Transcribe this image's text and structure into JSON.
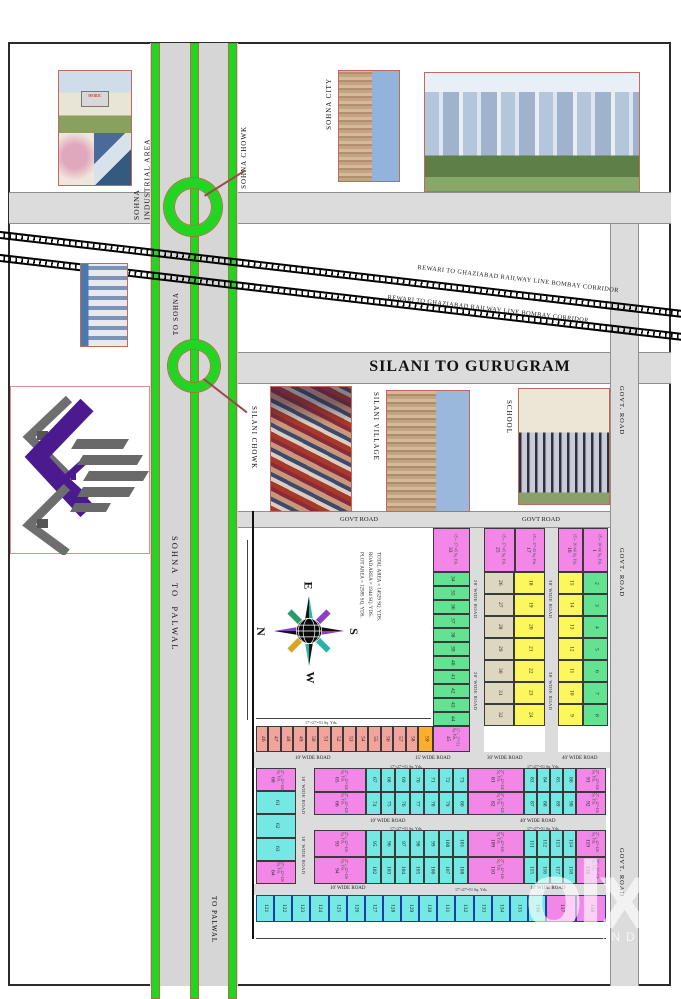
{
  "labels": {
    "sohna_industrial_area": "SOHNA\nINDUSTRIAL AREA",
    "sohna_city": "SOHNA CITY",
    "sohna_chowk": "SOHNA CHOWK",
    "silani_chowk": "SILANI CHOWK",
    "silani_village": "SILANI VILLAGE",
    "school": "SCHOOL",
    "to_sohna": "TO SOHNA",
    "sohna_to_palwal": "SOHNA  TO  PALWAL",
    "to_palwal": "TO PALWAL",
    "silani_to_gurugram": "SILANI TO GURUGRAM",
    "railway_line_1": "REWARI TO GHAZIABAD RAILWAY LINE BOMBAY CORRIDOR",
    "railway_line_2": "REWARI TO GHAZIABAD RAILWAY LINE BOMBAY CORRIDOR",
    "hsiidc_sign": "HSIIDC",
    "govt_road_v": "GOVT. ROAD",
    "govt_road_h": "GOVT ROAD"
  },
  "area_summary": {
    "line1": "TOTAL AREA = 14529 SQ. YDS.",
    "line2": "ROAD AREA = 1944 SQ. YDS.",
    "line3": "PLOT AREA = 12585 SQ. YDS."
  },
  "compass": {
    "north": "N",
    "south": "S",
    "east": "E",
    "west": "W"
  },
  "road_labels": {
    "wide10": "10' WIDE ROAD",
    "wide15": "15' WIDE ROAD",
    "wide20": "20' WIDE ROAD",
    "wide30": "30' WIDE ROAD",
    "wide40": "40' WIDE ROAD"
  },
  "annotations": {
    "dims_small": "17'×27'=51 Sq. Yds."
  },
  "watermark": {
    "brand": "olx",
    "region": "INDIA"
  },
  "plots": {
    "blockA_head": [
      {
        "n": "16",
        "dims": "15'×36'=60 Sq. Yds."
      },
      {
        "n": "1",
        "dims": "15'×36'=60 Sq. Yds."
      }
    ],
    "blockA_yellow": [
      "15",
      "14",
      "13",
      "12",
      "11",
      "10",
      "9"
    ],
    "blockA_green": [
      "2",
      "3",
      "4",
      "5",
      "6",
      "7",
      "8"
    ],
    "blockB_head": [
      {
        "n": "25",
        "dims": "15'×27'=45 Sq. Yds."
      },
      {
        "n": "17",
        "dims": "15'×27'=45 Sq. Yds."
      }
    ],
    "blockB_tan": [
      "26",
      "27",
      "28",
      "29",
      "30",
      "31",
      "32"
    ],
    "blockB_yellow": [
      "18",
      "19",
      "20",
      "21",
      "22",
      "23",
      "24"
    ],
    "blockC_head": [
      {
        "n": "33",
        "dims": "15'×27'=45 Sq. Yds."
      }
    ],
    "blockC_green": [
      "34",
      "35",
      "36",
      "37",
      "38",
      "39",
      "40",
      "41",
      "42",
      "43",
      "44"
    ],
    "blockC_foot": [
      {
        "n": "45",
        "dims": "17'×27'=51 Sq. Yds."
      }
    ],
    "salmon_row": [
      "46",
      "47",
      "48",
      "49",
      "50",
      "51",
      "52",
      "53",
      "54",
      "55",
      "56",
      "57",
      "58"
    ],
    "orange_cell": [
      {
        "n": "59",
        "bg": "#ffae2b"
      }
    ],
    "left_col": [
      {
        "n": "60",
        "dims": "27'×42'=126 Sq. Yds.",
        "bg": "#f387e8"
      },
      {
        "n": "61",
        "bg": "#74e8e2"
      },
      {
        "n": "62",
        "bg": "#74e8e2"
      },
      {
        "n": "63",
        "bg": "#74e8e2"
      },
      {
        "n": "64",
        "dims": "27'×42'=126 Sq. Yds.",
        "bg": "#f387e8"
      }
    ],
    "band1_pinkL": [
      {
        "n": "65",
        "dims": "27'×42'=126 Sq. Yds."
      },
      {
        "n": "66",
        "dims": "27'×42'=126 Sq. Yds."
      }
    ],
    "band1_cyan7": [
      "67",
      "68",
      "69",
      "70",
      "71",
      "72",
      "73",
      "74",
      "75",
      "76",
      "77",
      "78",
      "79",
      "80"
    ],
    "band1_pinkM": [
      {
        "n": "81",
        "dims": "27'×42'=126 Sq. Yds."
      },
      {
        "n": "82",
        "dims": "27'×42'=126 Sq. Yds."
      }
    ],
    "band1_cyan4": [
      "83",
      "84",
      "85",
      "86",
      "87",
      "88",
      "89",
      "90"
    ],
    "band1_pinkR": [
      {
        "n": "91",
        "dims": "27'×42'=126 Sq. Yds."
      },
      {
        "n": "92",
        "dims": "27'×42'=126 Sq. Yds."
      }
    ],
    "band2_pinkL": [
      {
        "n": "93",
        "dims": "27'×42'=126 Sq. Yds."
      },
      {
        "n": "94",
        "dims": "27'×42'=126 Sq. Yds."
      }
    ],
    "band2_cyan7": [
      "95",
      "96",
      "97",
      "98",
      "99",
      "100",
      "101",
      "102",
      "103",
      "104",
      "105",
      "106",
      "107",
      "108"
    ],
    "band2_pinkM": [
      {
        "n": "109",
        "dims": "27'×42'=126 Sq. Yds."
      },
      {
        "n": "110",
        "dims": "27'×42'=126 Sq. Yds."
      }
    ],
    "band2_cyan4": [
      "111",
      "112",
      "113",
      "114",
      "115",
      "116",
      "117",
      "118"
    ],
    "band2_pinkR": [
      {
        "n": "119",
        "dims": "27'×42'=126 Sq. Yds."
      },
      {
        "n": "120",
        "dims": "27'×42'=126 Sq. Yds."
      }
    ],
    "long_row": [
      "121",
      "122",
      "123",
      "124",
      "125",
      "126",
      "127",
      "128",
      "129",
      "130",
      "131",
      "132",
      "133",
      "134",
      "135",
      "136"
    ],
    "long_row_pink": [
      {
        "n": "137"
      },
      {
        "n": "138"
      }
    ]
  }
}
